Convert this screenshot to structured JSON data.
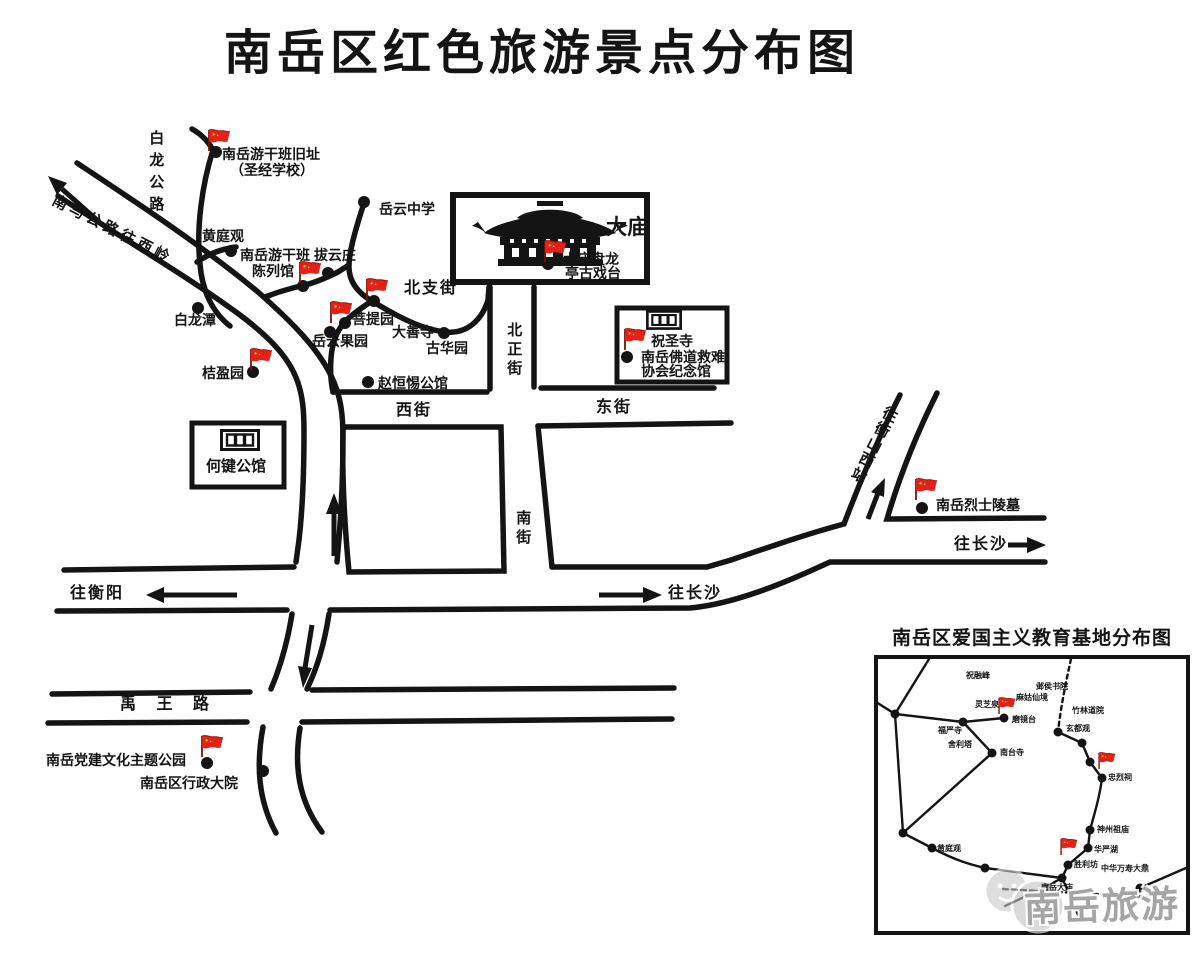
{
  "title": "南岳区红色旅游景点分布图",
  "colors": {
    "ink": "#141414",
    "flag_red": "#e32118",
    "flag_dark": "#9b130b",
    "watermark_gray": "#989898"
  },
  "main_labels": {
    "bailong_road": "白龙公路",
    "nanma_road": "南马公路往西岭",
    "ganban_site_1": "南岳游干班旧址",
    "ganban_site_2": "（圣经学校）",
    "huangtingguan": "黄庭观",
    "chenlieguan_1": "南岳游干班 拔云庄",
    "chenlieguan_2": "陈列馆",
    "yueyun_school": "岳云中学",
    "damiao": "大庙",
    "damiao_stage_1": "大庙盘龙",
    "damiao_stage_2": "亭古戏台",
    "beizhi_street": "北支街",
    "putiyuan": "菩提园",
    "yueyun_orchard": "岳云果园",
    "dashansi": "大善寺",
    "guhuayuan": "古华园",
    "bailongtan": "白龙潭",
    "juyingyuan": "桔盈园",
    "zhaohengti_mansion": "赵恒惕公馆",
    "zhushengsi": "祝圣寺",
    "jiunan_memorial_1": "南岳佛道救难",
    "jiunan_memorial_2": "协会纪念馆",
    "west_street": "西街",
    "east_street": "东街",
    "beizheng_street": "北正街",
    "south_street": "南街",
    "hejian_mansion": "何键公馆",
    "to_hengshan_west_station": "往衡山西站",
    "martyrs_cemetery": "南岳烈士陵墓",
    "to_changsha": "往长沙",
    "to_hengyang": "往衡阳",
    "yuwang_road": "禹 王 路",
    "dangjian_park": "南岳党建文化主题公园",
    "admin_compound": "南岳区行政大院"
  },
  "inset": {
    "title": "南岳区爱国主义教育基地分布图",
    "labels": {
      "zhurong_peak": "祝融峰",
      "lingzhi_spring": "灵芝泉",
      "yehou_academy": "邺侯书院",
      "magu_fairyland": "麻姑仙境",
      "zhulin_temple": "竹林道院",
      "xuandu_temple": "玄都观",
      "mojing_terrace": "磨镜台",
      "fuyan_temple": "福严寺",
      "sarira_stupa": "舍利塔",
      "nantai_temple": "南台寺",
      "martyrs_shrine": "忠烈祠",
      "shenzhou_temple": "神州祖庙",
      "huayan_lake": "华严湖",
      "victory_arch": "胜利坊",
      "wanshou_tripod": "中华万寿大鼎",
      "nanyue_damiao": "南岳大庙",
      "zhushengsi": "祝圣寺",
      "huangtingguan": "黄庭观"
    }
  },
  "watermark": {
    "text": "南岳旅游"
  }
}
